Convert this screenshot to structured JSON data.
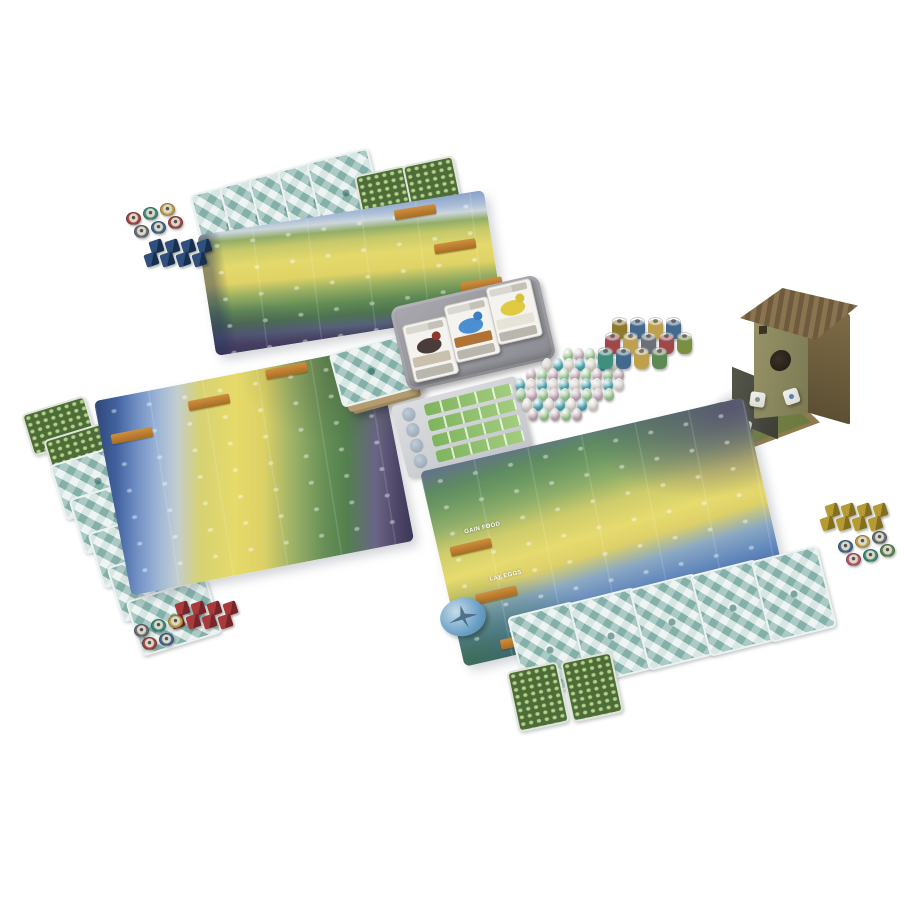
{
  "scene": {
    "description": "Tabletop photo of a bird-themed board game fully set up on a white surface",
    "surface_color": "#ffffff"
  },
  "palette": {
    "card_back_teal": "#9cc2bb",
    "bonus_card_green": "#4d6c38",
    "banner_orange": "#c98a3a",
    "mat_forest_green": "#5e8a62",
    "mat_grassland_yellow": "#e6db6e",
    "mat_wetland_blue": "#6288bd",
    "mat_dusk_purple": "#4c4566",
    "tray_gray": "#9a9aa0",
    "birdhouse_brown": "#8d7b4d"
  },
  "mats": {
    "action_labels": [
      "GAIN FOOD",
      "LAY EGGS",
      "DRAW BIRD CARDS"
    ]
  },
  "players": [
    {
      "color_name": "blue",
      "hand_count": 5,
      "bonus_count": 2,
      "cubes": {
        "count": 8,
        "light": "#2f4f7c",
        "dark": "#17304f"
      },
      "food_tokens": [
        "#a04848",
        "#3f8f7f",
        "#bfa14d",
        "#6b7078",
        "#44698f",
        "#9f4a4a"
      ]
    },
    {
      "color_name": "red",
      "hand_count": 5,
      "bonus_count": 2,
      "cubes": {
        "count": 8,
        "light": "#a93a3c",
        "dark": "#77252a"
      },
      "food_tokens": [
        "#6b7078",
        "#3f8f7f",
        "#bfa14d",
        "#a04848",
        "#44698f"
      ]
    },
    {
      "color_name": "yellow",
      "hand_count": 5,
      "bonus_count": 2,
      "cubes": {
        "count": 8,
        "light": "#b69b33",
        "dark": "#83701f"
      },
      "food_tokens": [
        "#44698f",
        "#bfa14d",
        "#6b7078",
        "#b05a6a",
        "#3f8f7f",
        "#5c8a52"
      ]
    }
  ],
  "center": {
    "deck_present": true,
    "tray_cards": [
      {
        "name": "dark-red-headed-bird",
        "bird": "#4a3c39",
        "head": "#8e372c",
        "band": "#c9c0ae"
      },
      {
        "name": "blue-swallow",
        "bird": "#4b8fd2",
        "head": "#3b7fc2",
        "band": "#b17236"
      },
      {
        "name": "yellow-finch",
        "bird": "#dfca41",
        "head": "#d6c13a",
        "band": "#e7e3d8"
      }
    ],
    "goal_board": {
      "rows": 4,
      "strip_color": "#8cbf66",
      "tile_count": 4
    },
    "egg_pile": {
      "rows": [
        4,
        7,
        9,
        10,
        9,
        7,
        5
      ],
      "colors": [
        "#97c48e",
        "#49a3ad",
        "#bfa7b2",
        "#d6d2ca"
      ]
    },
    "food_stacks": {
      "rows": [
        [
          "#8f7a2c",
          "#44698f",
          "#bfa14d",
          "#44698f"
        ],
        [
          "#a04848",
          "#bfa14d",
          "#6b7078",
          "#a04848",
          "#7a8f3f"
        ],
        [
          "#3f8f7f",
          "#44698f",
          "#bfa14d",
          "#5c8a52"
        ]
      ]
    },
    "dice": {
      "count": 5,
      "pips": [
        "#5a7fae",
        "#8a8f96",
        "#5a7fae",
        "#a33c3c",
        "#a33c3c"
      ]
    },
    "first_player_token_color": "#6ba1c6"
  }
}
